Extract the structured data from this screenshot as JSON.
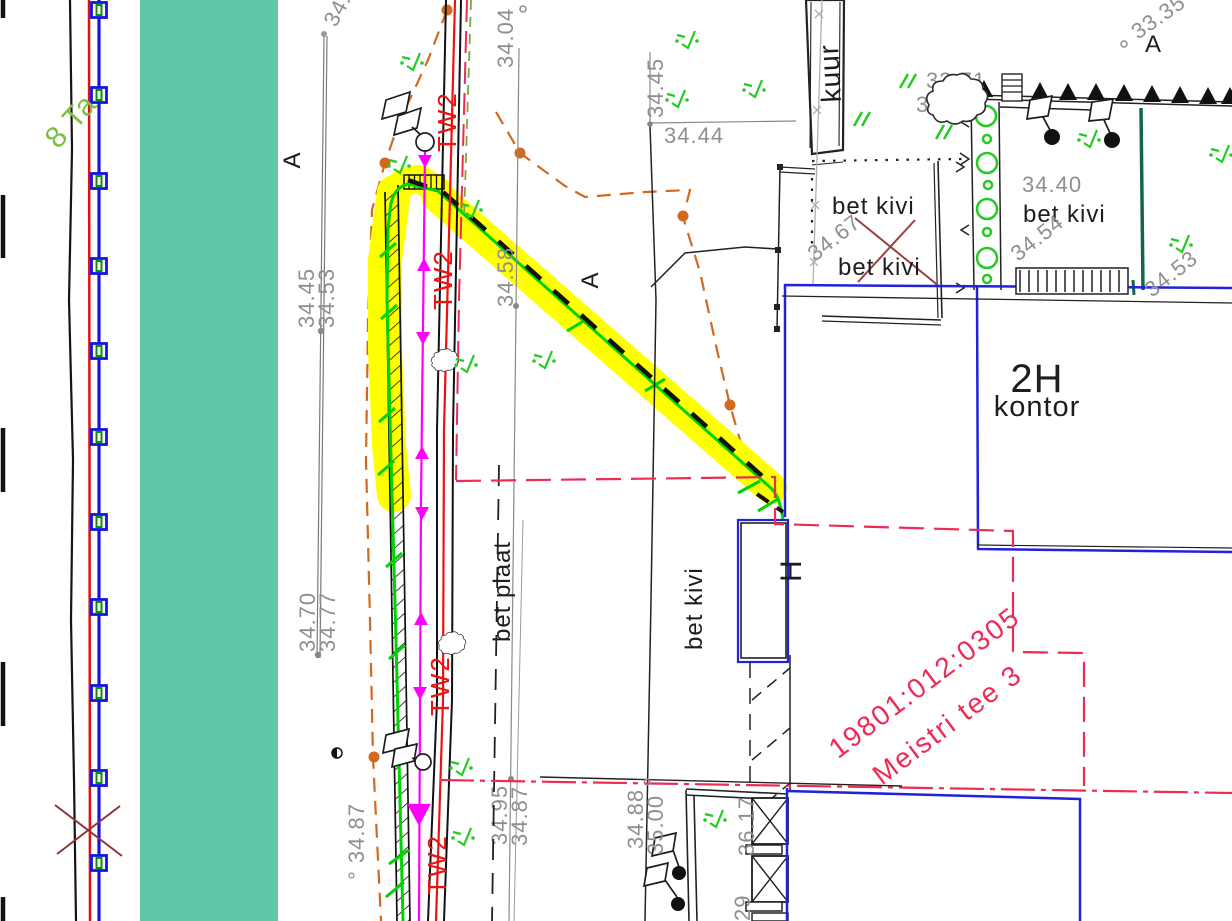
{
  "labels": {
    "road_name": "8 Ta",
    "section_marker": "A",
    "pipe": "TW2",
    "kuur": "kuur",
    "bet_kivi": "bet kivi",
    "bet_plaat": "bet plaat",
    "building_2h": "2H",
    "kontor": "kontor",
    "building_h": "H",
    "parcel_code": "19801:012:0305",
    "parcel_address": "Meistri tee 3"
  },
  "elevations": {
    "e34_04": "34.04",
    "e34_45": "34.45",
    "e34_44": "34.44",
    "e34_58": "34.58",
    "e34_53": "34.53",
    "e34_70": "34.70",
    "e34_77": "34.77",
    "e34_87_deg": "° 34.87",
    "e34_95": "34.95",
    "e34_87": "34.87",
    "e34_88": "34.88",
    "e35_00": "35.00",
    "e36_17": "36.17",
    "e36_part": "29",
    "e34_40": "34.40",
    "e34_54": "34.54",
    "e34_67": "34.67",
    "e33_71": "33.71",
    "e34_06": "34.06",
    "e33_35": "33.35",
    "e34_top": "34."
  },
  "colors": {
    "teal_band": "#5fc6a7",
    "highlight_yellow": "#ffff00",
    "cable_green": "#00d400",
    "vegetation_green": "#22cc22",
    "road_name_green": "#7cc043",
    "utility_orange": "#d2691e",
    "pipe_red": "#ee1111",
    "boundary_crimson": "#ee2b57",
    "cross_dark_red": "#8d3535",
    "building_blue": "#2222dd",
    "fence_blue": "#1515e0",
    "label_gray": "#8f8f8f",
    "dark_green_line": "#14654a",
    "magenta_line": "#ff00ff"
  }
}
